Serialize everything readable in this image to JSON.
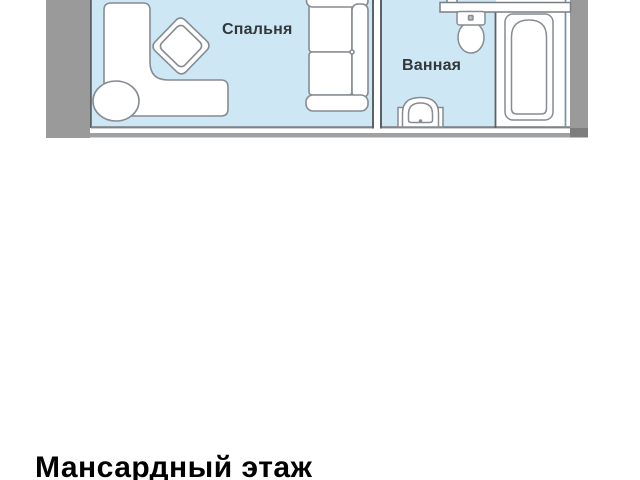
{
  "title": {
    "text": "Мансардный этаж"
  },
  "floor_plan": {
    "rooms": [
      {
        "name": "bedroom",
        "label": "Спальня"
      },
      {
        "name": "bathroom",
        "label": "Ванная"
      }
    ],
    "fixtures": [
      "corner-sofa-icon",
      "ottoman-icon",
      "armchair-icon",
      "sofa-bed-icon",
      "wall-shelf-icon",
      "toilet-icon",
      "sink-icon",
      "bathtub-icon"
    ],
    "colors": {
      "room_fill": "#cee7f4",
      "alcove_fill": "#ffffff",
      "wall_gray": "#9a9a9b",
      "wall_dark": "#7d7d7e",
      "wall_line": "#9fa0a2",
      "thin_line": "#5d6165",
      "furniture_outline": "#868c92",
      "label_text": "#33383d",
      "title_text": "#000000"
    }
  }
}
